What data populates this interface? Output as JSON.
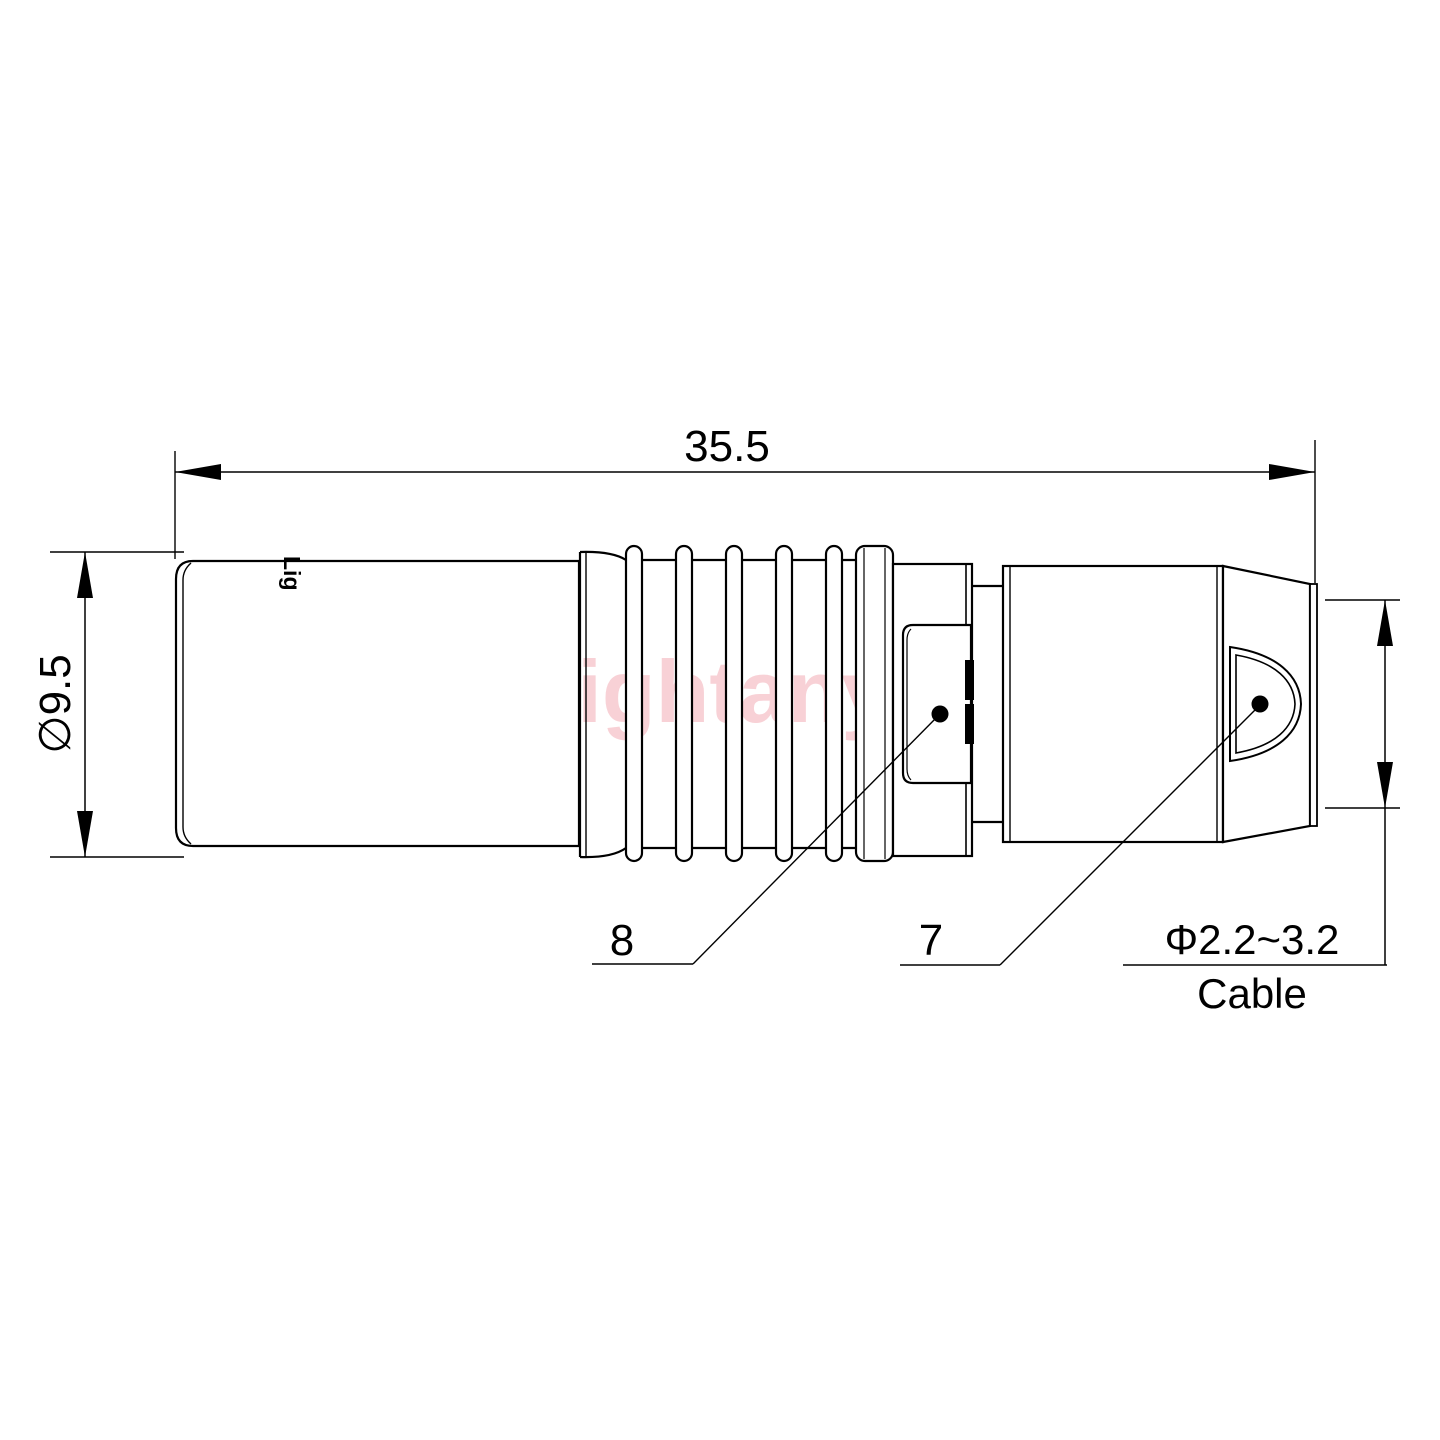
{
  "meta": {
    "background_color": "#ffffff",
    "line_color": "#000000",
    "watermark_color": "#f5c2c8"
  },
  "watermark": {
    "text": "Lightany"
  },
  "part": {
    "engraving": "Lig"
  },
  "dimensions": {
    "overall_length": {
      "value": "35.5"
    },
    "body_diameter": {
      "value": "∅9.5"
    },
    "cable_diameter": {
      "value": "Φ2.2~3.2",
      "label": "Cable"
    }
  },
  "callouts": {
    "rear_position": "8",
    "front_position": "7"
  }
}
